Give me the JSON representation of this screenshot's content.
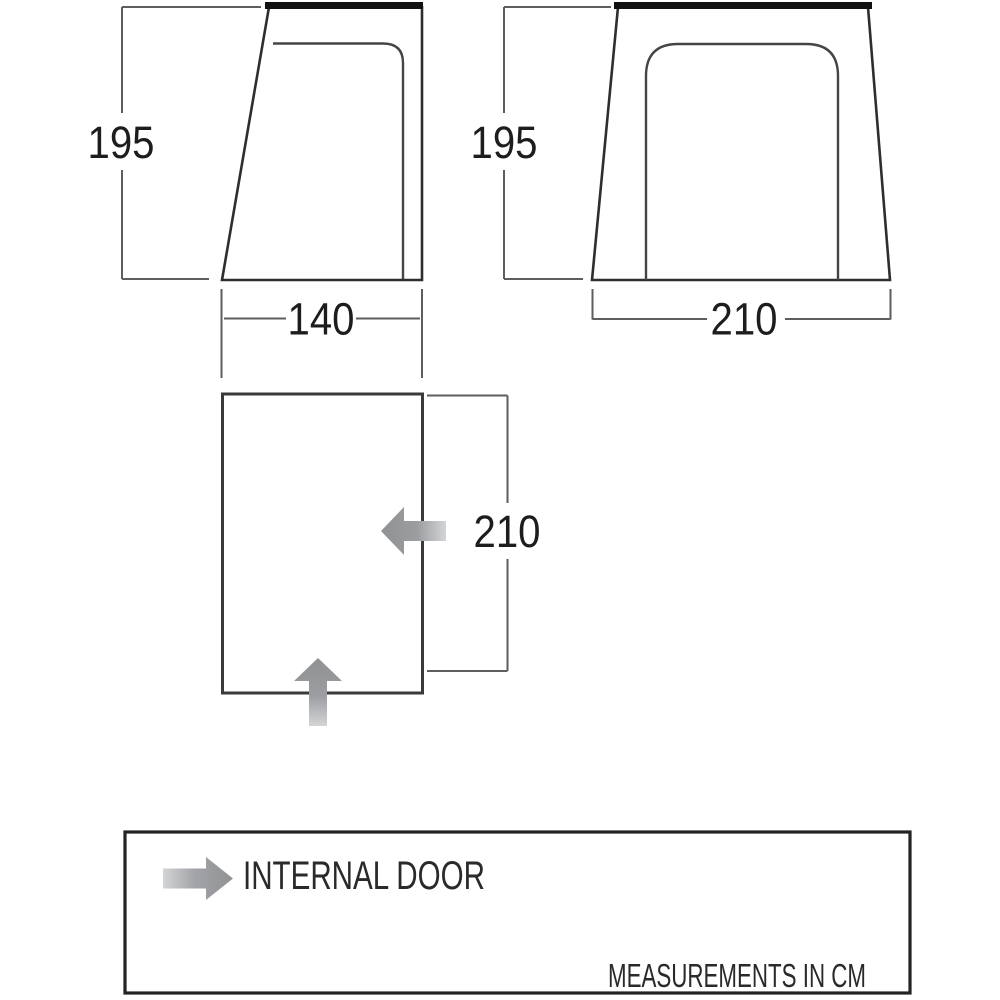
{
  "diagram": {
    "title_semantic": "awning dimension diagram",
    "side_view": {
      "height_label": "195",
      "width_label": "140"
    },
    "front_view": {
      "height_label": "195",
      "width_label": "210"
    },
    "floor_plan": {
      "depth_label": "210"
    },
    "legend": {
      "arrow_label": "INTERNAL DOOR",
      "units_note": "MEASUREMENTS IN CM"
    }
  },
  "colors": {
    "outline": "#2e2e2e",
    "roof_edge": "#111111",
    "inner_line": "#454545",
    "dimension_line": "#5e5e5e",
    "floor_outline": "#3a3a3a",
    "arrow_gray": "#8f9193",
    "arrow_light": "#cfd1d3",
    "text": "#1d1d1d",
    "legend_border": "#232323"
  }
}
